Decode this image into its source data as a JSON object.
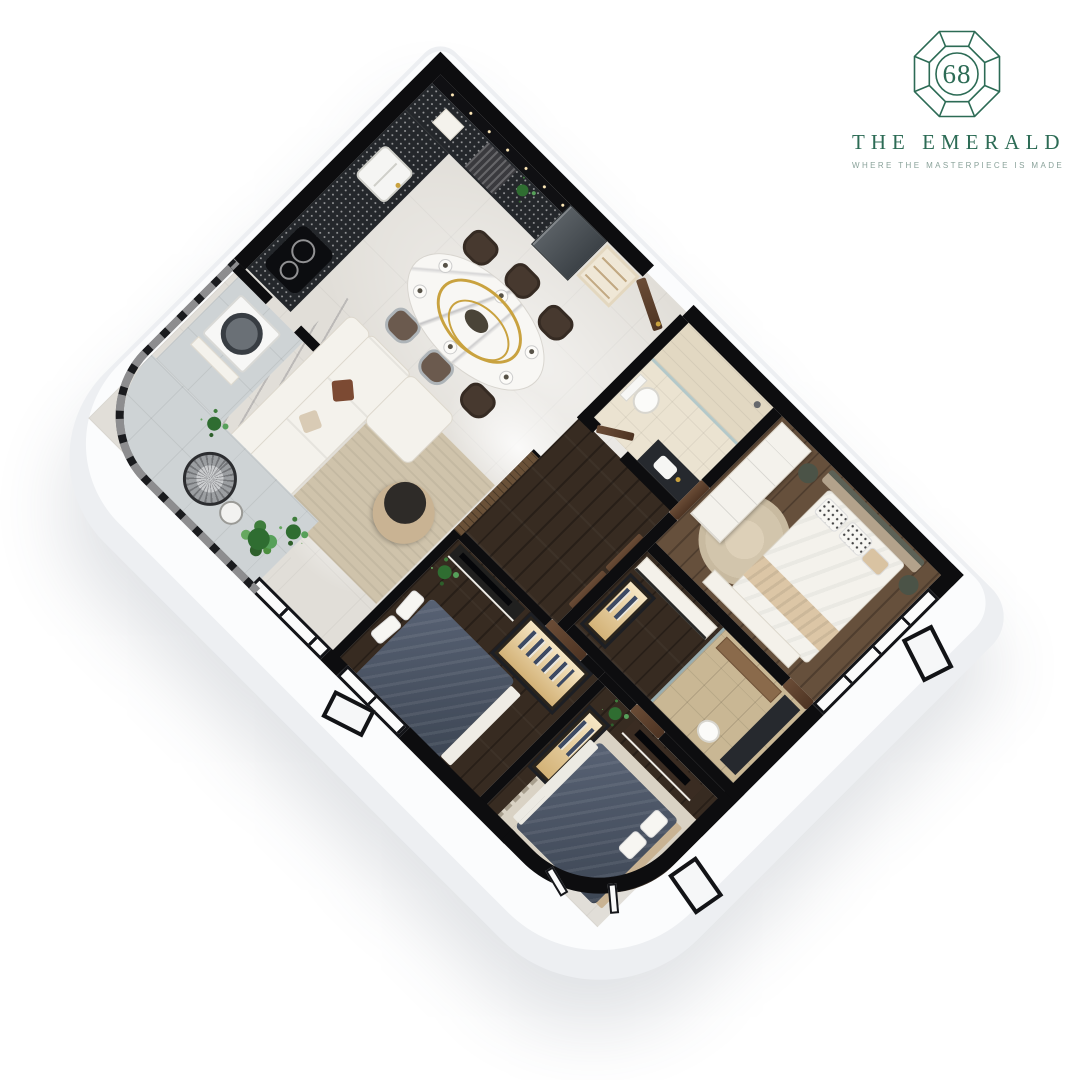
{
  "brand": {
    "number": "68",
    "name": "THE EMERALD",
    "tagline": "WHERE THE MASTERPIECE IS MADE",
    "color": "#2c6b55",
    "tagline_color": "#8aa29a"
  },
  "scene": {
    "type": "3D isometric apartment floor-plan render, rotated 45 degrees",
    "palette": {
      "walls": "#0d0d0f",
      "slab": "#edeff2",
      "tile_floor": "#e1ded8",
      "wood_floor_dark": "#372b21",
      "wood_floor_medium": "#66503c",
      "balcony_tile": "#ced3d5",
      "bed_navy": "#4a5466",
      "counter_stone": "#24272b",
      "accent_gold": "#c9a23f",
      "greenery": "#3f7d3c"
    },
    "rooms": [
      {
        "name": "kitchen",
        "features": [
          "L-shaped black stone counter",
          "induction cooktop",
          "double sink",
          "refrigerator",
          "cream cabinetry with lit black upper strip"
        ]
      },
      {
        "name": "dining-area",
        "features": [
          "oval marble dining table",
          "six upholstered chairs",
          "gold ring pendant light",
          "table setting plates"
        ]
      },
      {
        "name": "living-room",
        "features": [
          "white L-shaped sofa",
          "brown accent pillow",
          "round two-tone coffee table",
          "striped beige rug",
          "marble feature wall",
          "sheer curtain to balcony"
        ]
      },
      {
        "name": "entry-hall",
        "features": [
          "open dark-wood entrance door",
          "back-lit shoe cabinet",
          "dark slatted cabinet panel"
        ]
      },
      {
        "name": "bathroom-1",
        "features": [
          "glass walk-in shower",
          "toilet",
          "dark stone vanity with basin",
          "frosted green window"
        ]
      },
      {
        "name": "bedroom-2",
        "features": [
          "double bed with beige headboard",
          "white wardrobe",
          "round beige rug",
          "dark green side tables",
          "white console",
          "corner windows"
        ]
      },
      {
        "name": "hallway",
        "features": [
          "dark wood flooring",
          "dark wood doors"
        ]
      },
      {
        "name": "wardrobe-corridor",
        "features": [
          "long white console",
          "back-lit glass closet"
        ]
      },
      {
        "name": "ensuite-bathroom",
        "features": [
          "wood-look tile floor",
          "glass partition",
          "wood cabinet",
          "dark counter",
          "toilet"
        ]
      },
      {
        "name": "master-bedroom",
        "features": [
          "navy double bed",
          "back-lit glass wardrobe",
          "media console with TV",
          "floor-to-ceiling windows",
          "potted plant"
        ]
      },
      {
        "name": "bedroom-3",
        "features": [
          "navy double bed on fringed rug",
          "TV media panel",
          "back-lit glass wardrobe",
          "curved corner window wall",
          "open tilted window panes"
        ]
      },
      {
        "name": "balcony",
        "features": [
          "curved black baluster railing",
          "round wire lounge chair",
          "side table",
          "potted plants",
          "large gray floor tiles"
        ]
      },
      {
        "name": "utility-area",
        "features": [
          "front-load washing machine",
          "white storage cabinet"
        ]
      }
    ]
  }
}
